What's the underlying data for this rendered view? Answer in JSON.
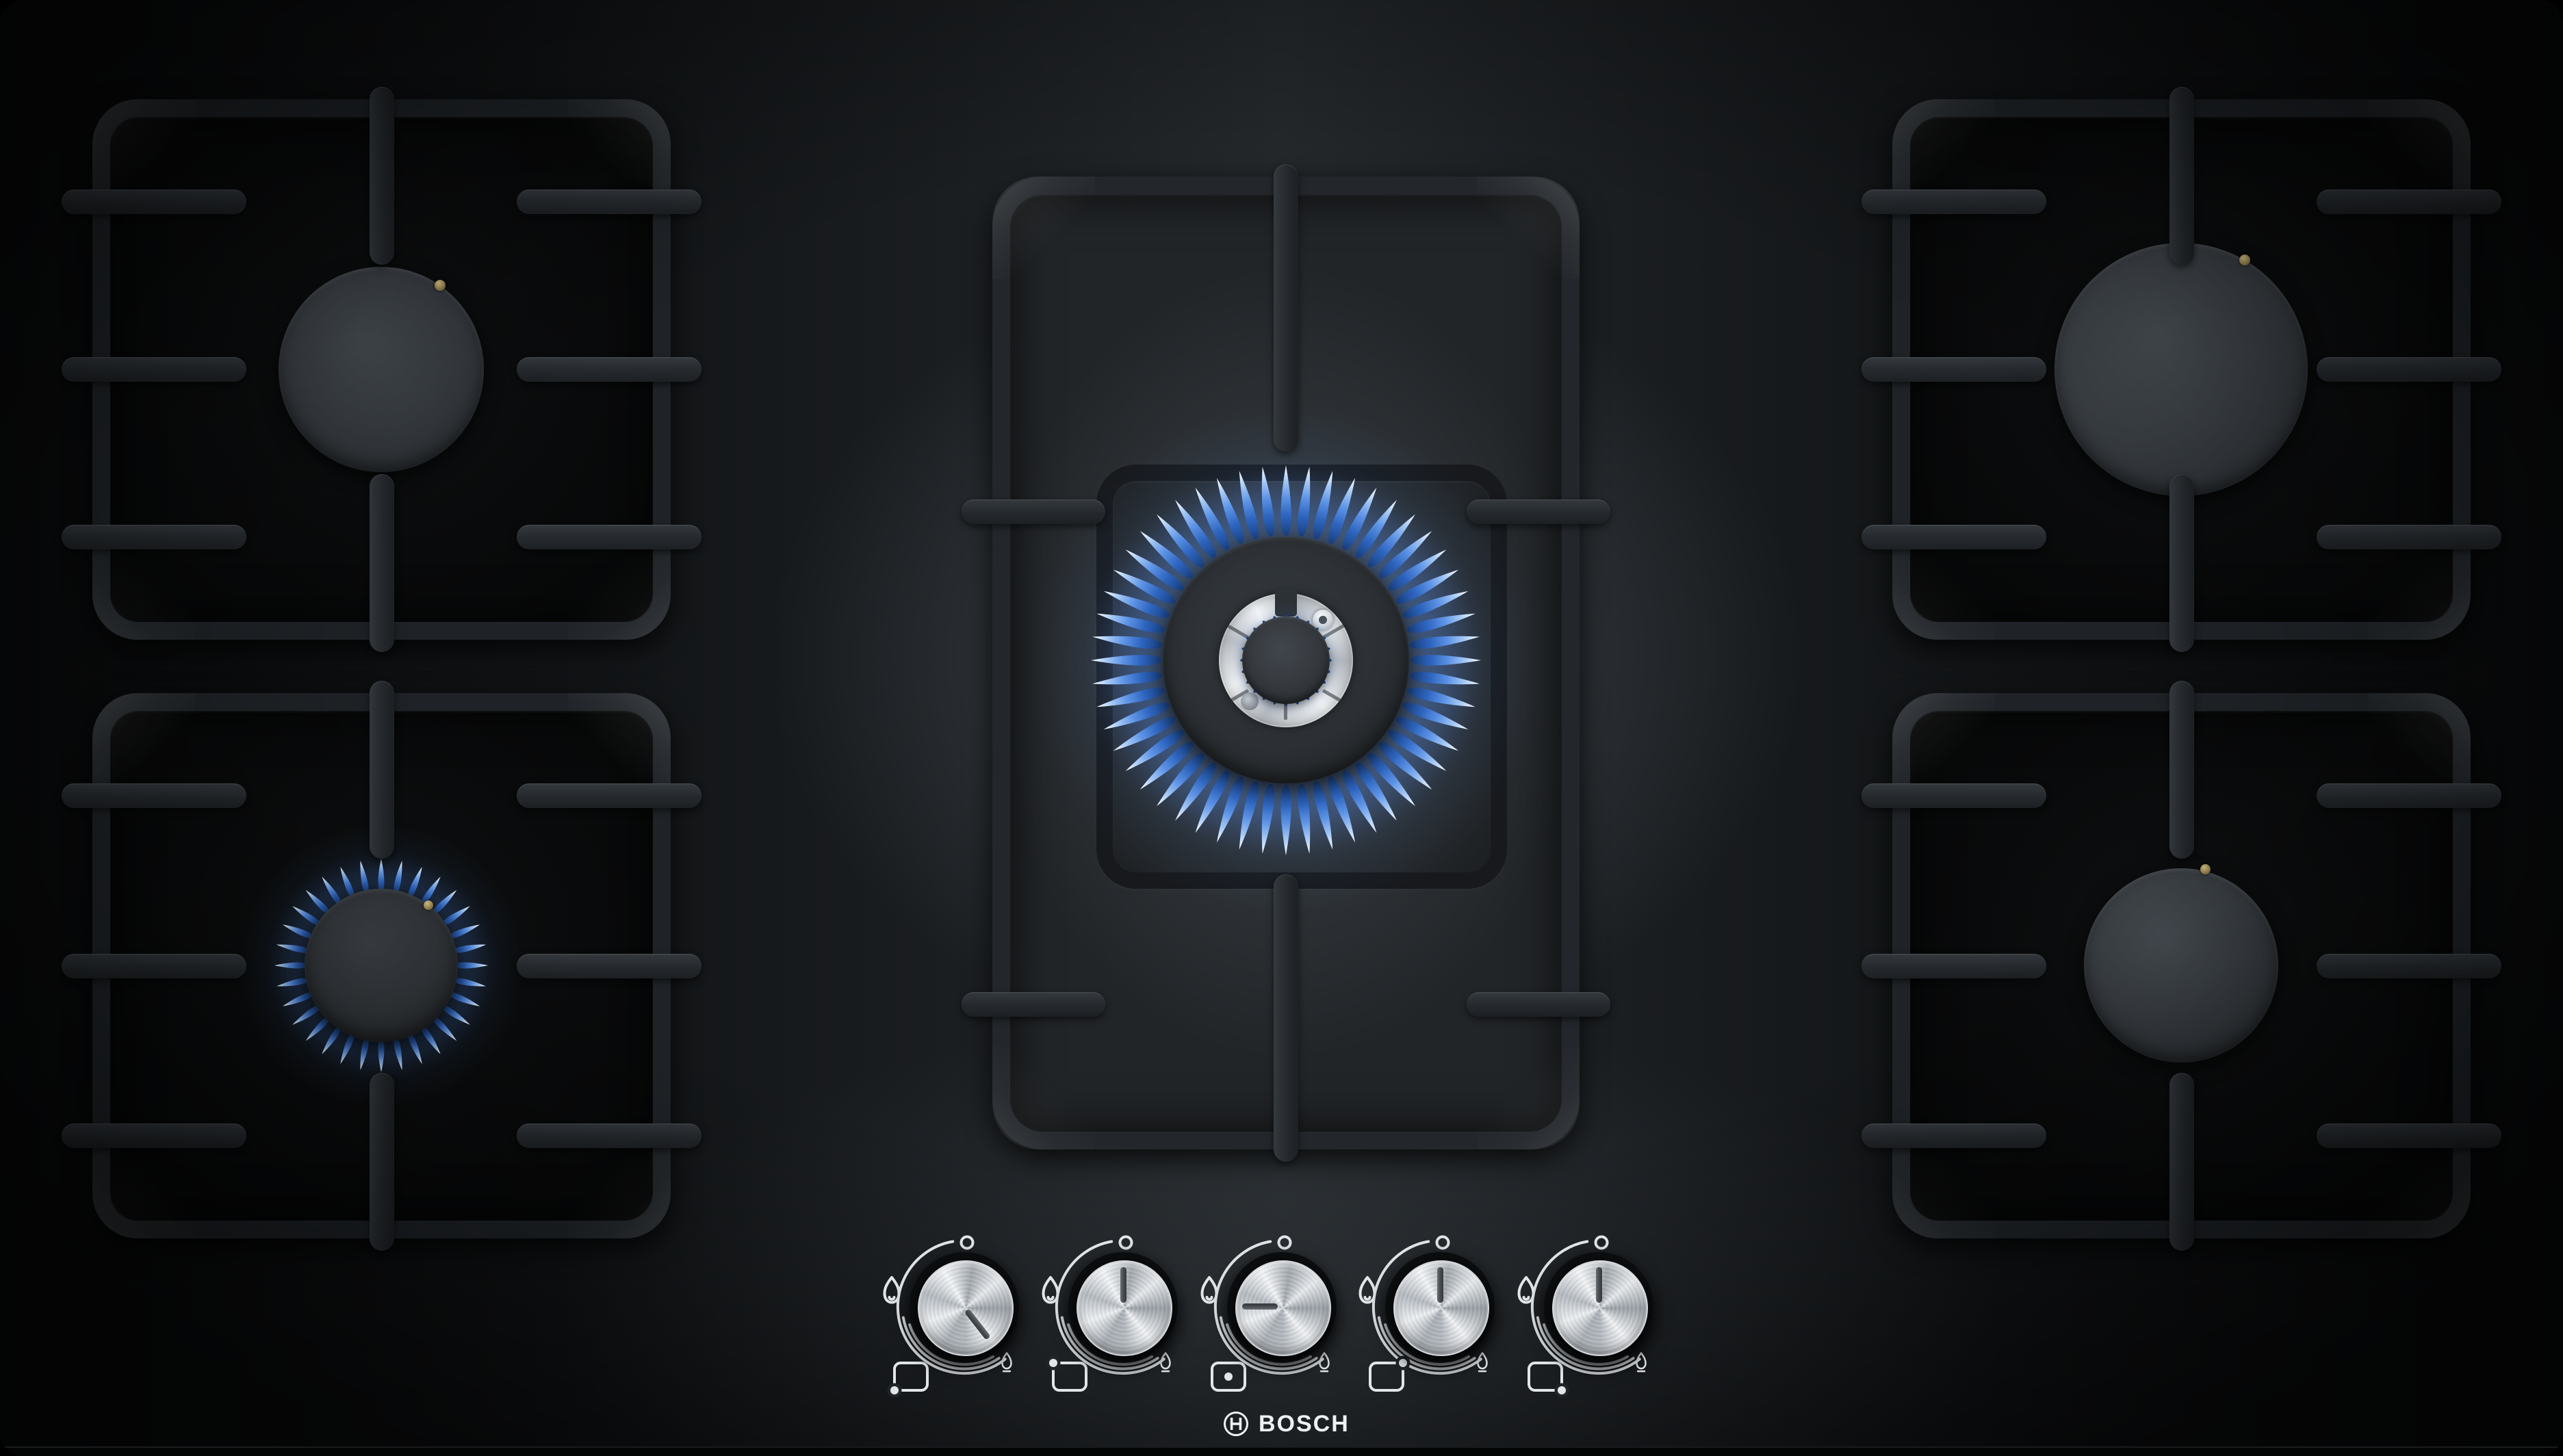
{
  "brand": {
    "name": "BOSCH",
    "symbol": "bosch-armature-in-circle"
  },
  "product": {
    "type": "gas hob",
    "burner_count": 5,
    "surface": "black tempered glass",
    "pan_supports": "cast iron"
  },
  "burners": [
    {
      "id": "top-left",
      "size": "standard",
      "state": "off",
      "igniter": "gold electrode top-right"
    },
    {
      "id": "bottom-left",
      "size": "economy",
      "state": "lit-low-flame",
      "flame_color": "#5e94e6"
    },
    {
      "id": "center",
      "size": "dual-ring wok",
      "state": "lit-high-flame",
      "flame_color": "#5e94e6",
      "detail": "stainless inner ring with spark igniter and thermocouple"
    },
    {
      "id": "top-right",
      "size": "large",
      "state": "off",
      "igniter": "gold electrode top-right"
    },
    {
      "id": "bottom-right",
      "size": "standard",
      "state": "off",
      "igniter": "gold electrode top-center"
    }
  ],
  "controls": {
    "knobs": [
      {
        "id": "knob-1",
        "controls_burner": "bottom-left",
        "dot_position": "bottom-left",
        "indicator_angle_deg": 142,
        "setting": "low flame"
      },
      {
        "id": "knob-2",
        "controls_burner": "top-left",
        "dot_position": "top-left",
        "indicator_angle_deg": 0,
        "setting": "off"
      },
      {
        "id": "knob-3",
        "controls_burner": "center",
        "dot_position": "center",
        "indicator_angle_deg": 270,
        "setting": "high flame"
      },
      {
        "id": "knob-4",
        "controls_burner": "top-right",
        "dot_position": "top-right",
        "indicator_angle_deg": 0,
        "setting": "off"
      },
      {
        "id": "knob-5",
        "controls_burner": "bottom-right",
        "dot_position": "bottom-right",
        "indicator_angle_deg": 0,
        "setting": "off"
      }
    ],
    "dial_markers": {
      "off": "small circle at top",
      "max": "large flame icon upper-left",
      "min": "small flame icon lower-right",
      "scale": "triple tapering arc"
    },
    "knob_material": "brushed stainless steel"
  },
  "colors": {
    "glass_black": "#0a0b0c",
    "grate_gray": "#24282c",
    "flame_blue": "#5e94e6",
    "flame_tip": "#e9f3ff",
    "knob_silver": "#d9dde1",
    "marking_white": "#e2e6e9",
    "igniter_gold": "#b49b55"
  }
}
